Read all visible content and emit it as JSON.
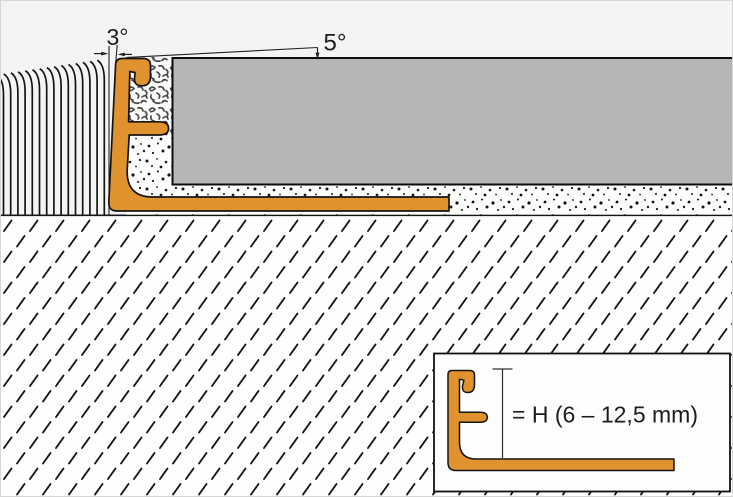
{
  "diagram": {
    "annotations": {
      "profile_tilt_angle": "3°",
      "surface_slope_angle": "5°",
      "inset_height_label": "= H (6 – 12,5 mm)"
    },
    "colors": {
      "profile_orange": "#E0922E",
      "tile_gray": "#B7B5B8",
      "background": "#F4F4F3",
      "paper_white": "#FDFDFC",
      "outline_black": "#151515"
    }
  }
}
